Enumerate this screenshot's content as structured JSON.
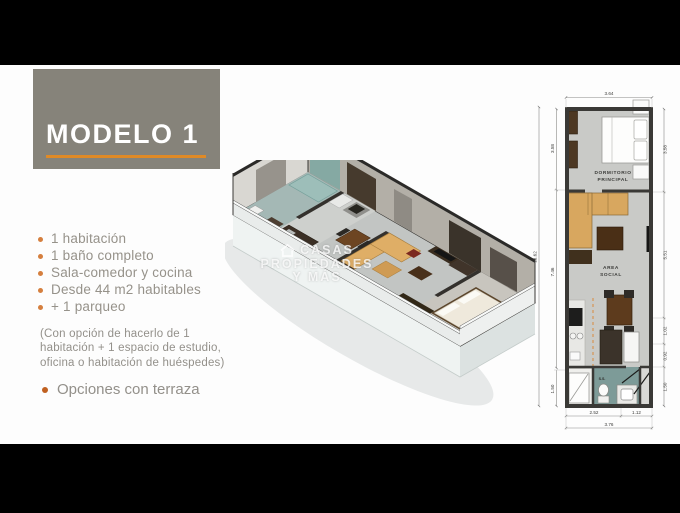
{
  "slide": {
    "title": "MODELO 1",
    "features": [
      "1 habitación",
      "1 baño completo",
      "Sala-comedor y cocina",
      "Desde 44 m2 habitables",
      "+ 1 parqueo"
    ],
    "note": "(Con opción de hacerlo de 1 habitación + 1 espacio de estudio, oficina o habitación de huéspedes)",
    "extra_feature": "Opciones con terraza",
    "colors": {
      "title_box": "#86837a",
      "accent_orange": "#e08a26",
      "bullet_orange": "#d57f3e",
      "text_gray": "#96928a",
      "letterbox": "#000000"
    }
  },
  "watermark": {
    "line1": "CASAS",
    "line2": "PROPIEDADES",
    "line3": "Y MÁS"
  },
  "floorplan_2d": {
    "room_labels": {
      "bedroom_line1": "DORMITORIO",
      "bedroom_line2": "PRINCIPAL",
      "social_line1": "AREA",
      "social_line2": "SOCIAL",
      "bath": "S.S."
    },
    "dimensions": {
      "top_width": "3.64",
      "left_total": "13.62",
      "left_bedroom": "3.58",
      "left_social": "7.46",
      "left_bath": "1.50",
      "right_bedroom": "3.58",
      "right_social": "5.51",
      "right_kitchen": "1.02",
      "right_hall": "0.92",
      "right_bath": "1.50",
      "bottom_kitchen": "2.52",
      "bottom_entry": "1.12",
      "bottom_total": "3.76"
    },
    "wall_color": "#3a3936",
    "bath_floor_color": "#7d9b98"
  }
}
